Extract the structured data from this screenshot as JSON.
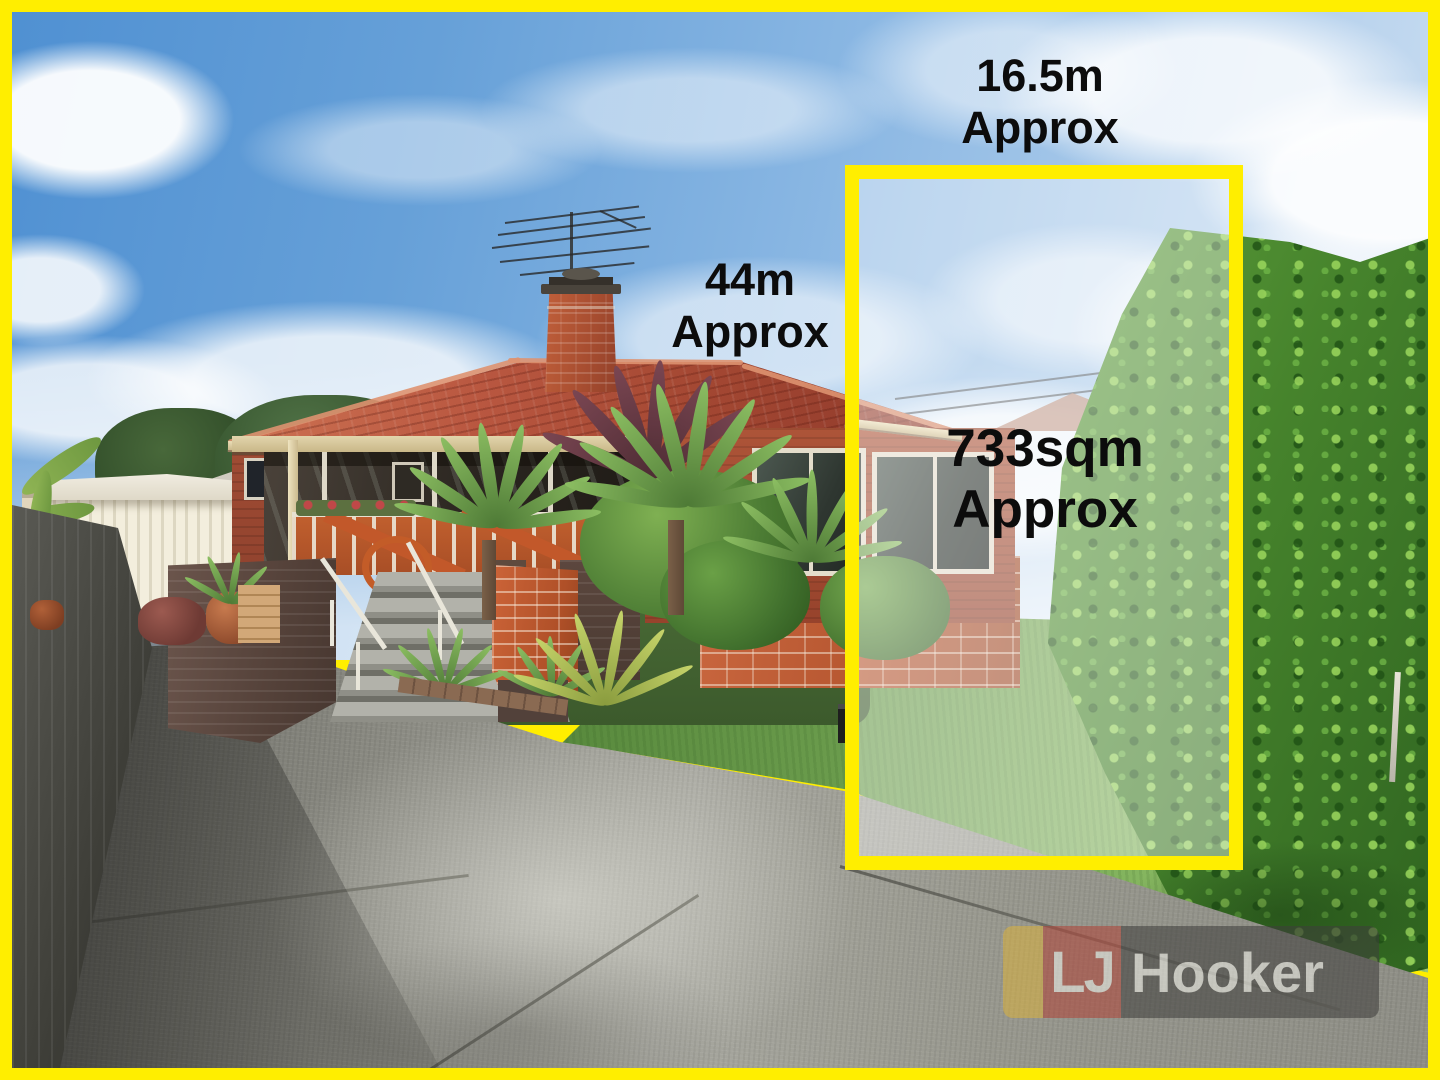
{
  "annotations": {
    "frontage": {
      "value": "16.5m",
      "qualifier": "Approx"
    },
    "depth": {
      "value": "44m",
      "qualifier": "Approx"
    },
    "area": {
      "value": "733sqm",
      "qualifier": "Approx"
    }
  },
  "logo": {
    "initials": "LJ",
    "name": "Hooker"
  },
  "colors": {
    "frame_yellow": "#ffee00",
    "boundary_yellow": "#ffee00",
    "boundary_fill": "rgba(255,255,255,0.40)",
    "annotation_text": "#0c0c0c",
    "logo_yellow": "#d9b13e",
    "logo_red": "#b04438",
    "logo_dark": "#3f3e3c",
    "logo_text": "#efefe8",
    "roof_red": "#a84a32",
    "brick_red": "#9c4832",
    "lawn_green": "#6fa050",
    "hedge_green": "#46832c",
    "driveway_grey": "#98988e",
    "sky_blue": "#66a0d8"
  }
}
